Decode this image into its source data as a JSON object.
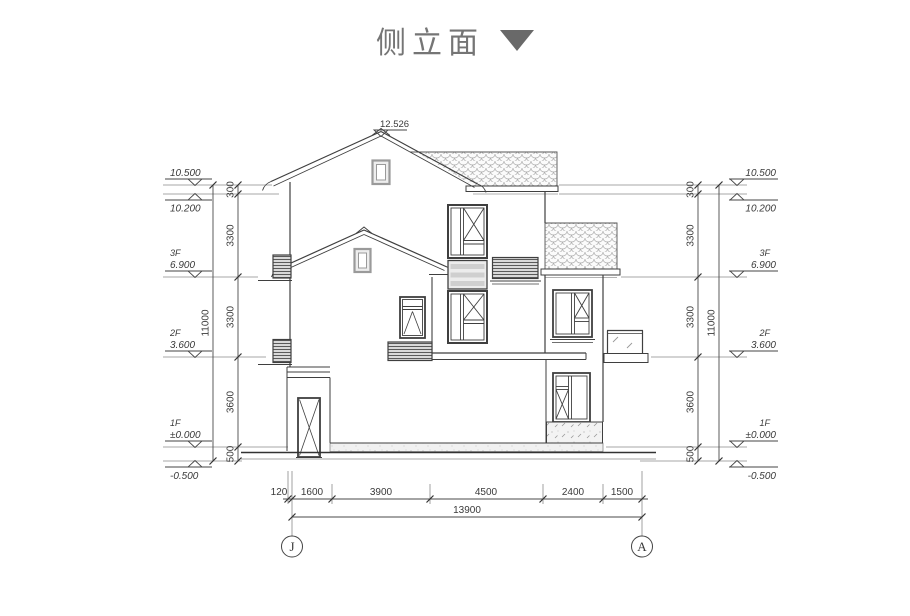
{
  "title": {
    "text": "侧立面"
  },
  "colors": {
    "line": "#3f3f3f",
    "dim_text": "#3a3a3a",
    "level_line": "#8a8a8a",
    "tile_stroke": "#adadad",
    "gray_window": "#9a9a9a",
    "title_text": "#757575",
    "title_triangle": "#696969"
  },
  "elevation": {
    "ridge": "12.526",
    "levels": {
      "top": "10.500",
      "eave": "10.200",
      "f3_label": "3F",
      "f3": "6.900",
      "f2_label": "2F",
      "f2": "3.600",
      "f1_label": "1F",
      "f1": "±0.000",
      "grade": "-0.500"
    },
    "vertical_dims": {
      "segs": [
        "300",
        "3300",
        "3300",
        "3600",
        "500"
      ],
      "total": "11000"
    },
    "horizontal_dims": {
      "segs": [
        "120",
        "1600",
        "3900",
        "4500",
        "2400",
        "1500"
      ],
      "total": "13900"
    },
    "axes": {
      "left": "J",
      "right": "A"
    }
  }
}
